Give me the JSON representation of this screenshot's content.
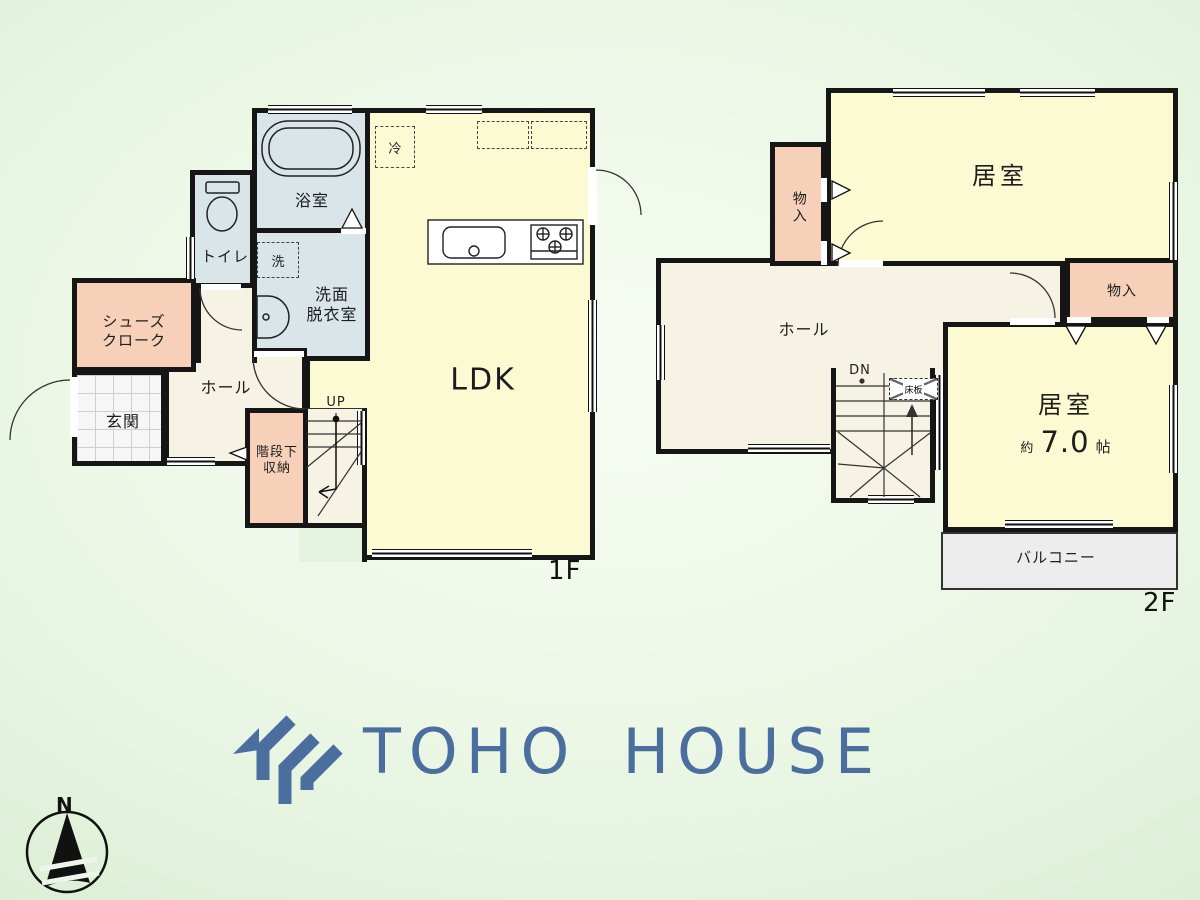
{
  "palette": {
    "wall": "#161616",
    "room_yellow": "#fcfad2",
    "wet_blue": "#d9e5e9",
    "storage_peach": "#f7d0b9",
    "hall_cream": "#f6f2e4",
    "balcony_gray": "#ededed",
    "logo_blue": "#4a6f9e",
    "background_green": "#e4f2de"
  },
  "floor1": {
    "floor_label": "1F",
    "rooms": {
      "ldk": "LDK",
      "bath": "浴室",
      "washroom": {
        "line1": "洗面",
        "line2": "脱衣室"
      },
      "toilet": "トイレ",
      "shoes_closet": {
        "line1": "シューズ",
        "line2": "クローク"
      },
      "entrance": "玄関",
      "hall": "ホール",
      "under_stair_storage": {
        "line1": "階段下",
        "line2": "収納"
      }
    },
    "annotations": {
      "up": "UP",
      "fridge": "冷",
      "washer": "洗"
    }
  },
  "floor2": {
    "floor_label": "2F",
    "rooms": {
      "bedroom_top": "居室",
      "closet_left": "物入",
      "hall": "ホール",
      "closet_right": "物入",
      "bedroom_right": {
        "name": "居室",
        "size_prefix": "約",
        "size_value": "7.0",
        "size_unit": "帖"
      },
      "balcony": "バルコニー"
    },
    "annotations": {
      "down": "DN",
      "floor_board": "床板"
    }
  },
  "logo": {
    "text": "TOHO HOUSE"
  },
  "compass": {
    "north": "N"
  }
}
